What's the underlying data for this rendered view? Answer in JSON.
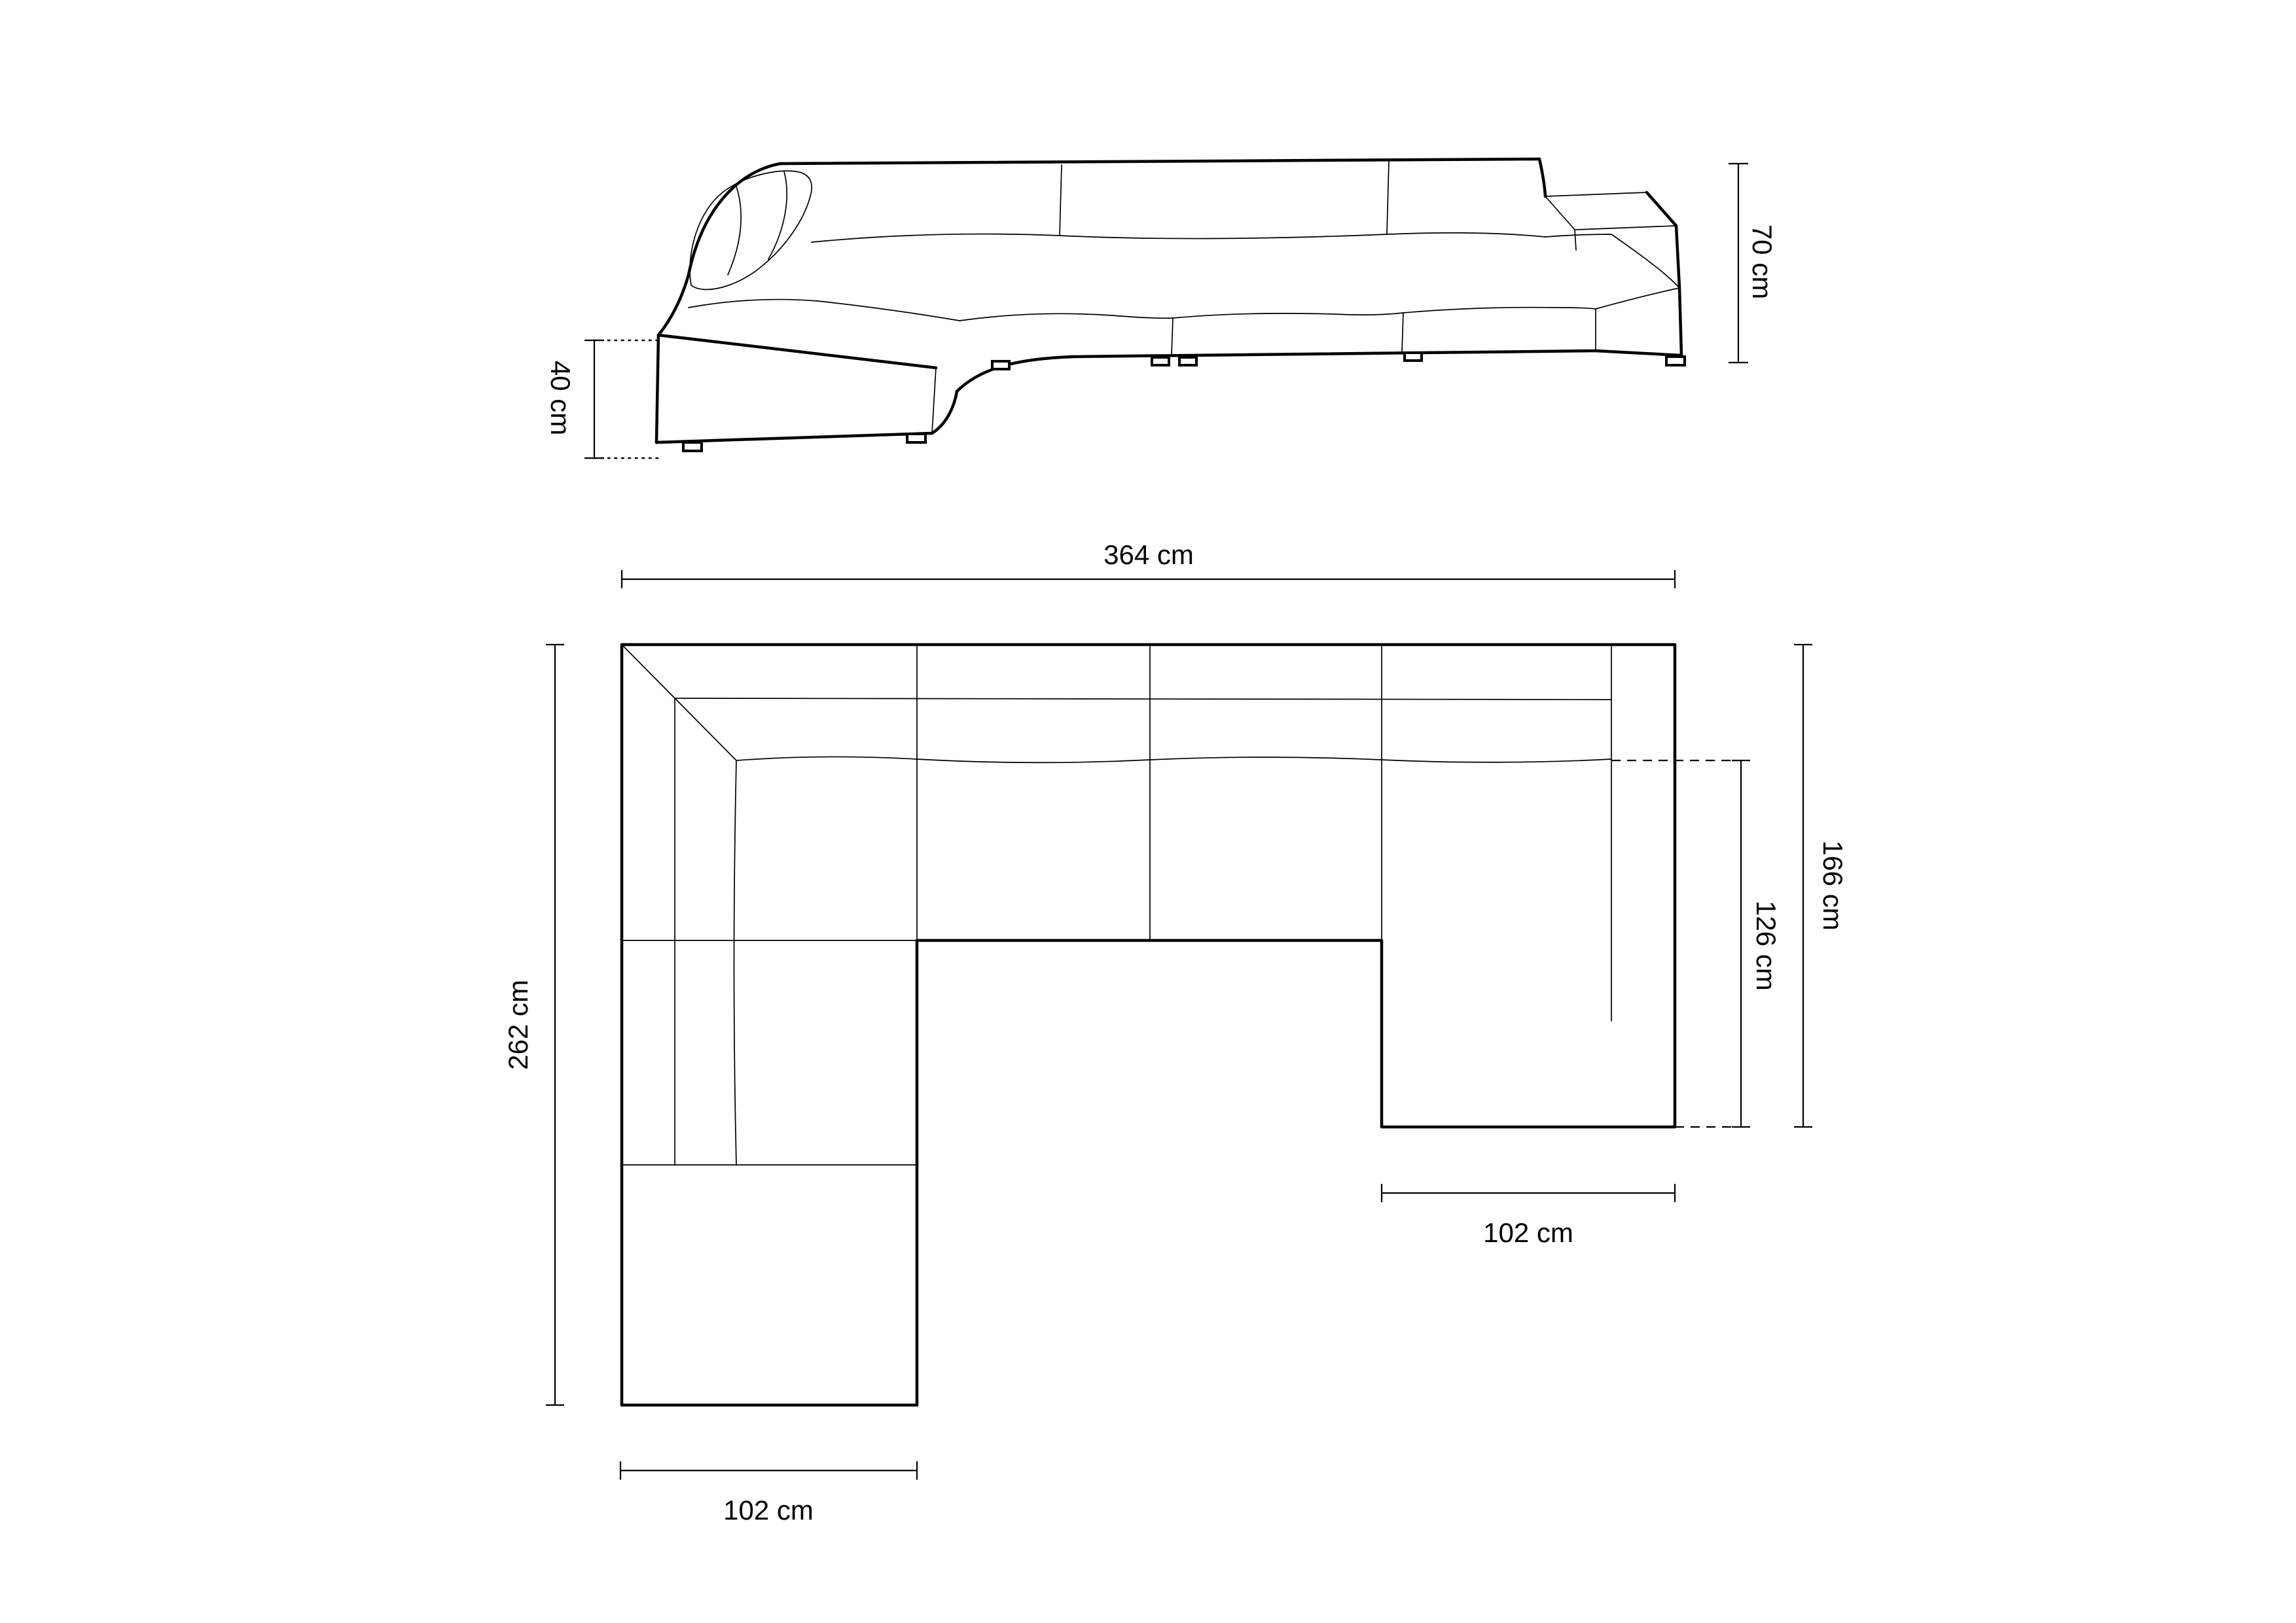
{
  "page": {
    "background_color": "#ffffff",
    "line_color": "#000000",
    "description": "U-shaped modular sofa dimension diagram with front elevation view and top plan view"
  },
  "elevation_view": {
    "labels": {
      "height": "70 cm",
      "seat_height": "40 cm"
    }
  },
  "plan_view": {
    "labels": {
      "overall_width": "364 cm",
      "overall_depth": "262 cm",
      "right_side_depth": "166 cm",
      "chaise_inner_length": "126 cm",
      "left_arm_width": "102 cm",
      "right_chaise_width": "102 cm"
    }
  },
  "dimensions_cm": {
    "overall_width": 364,
    "overall_depth": 262,
    "right_side_depth": 166,
    "chaise_inner_length": 126,
    "left_arm_width": 102,
    "right_chaise_width": 102,
    "height": 70,
    "seat_height": 40
  }
}
